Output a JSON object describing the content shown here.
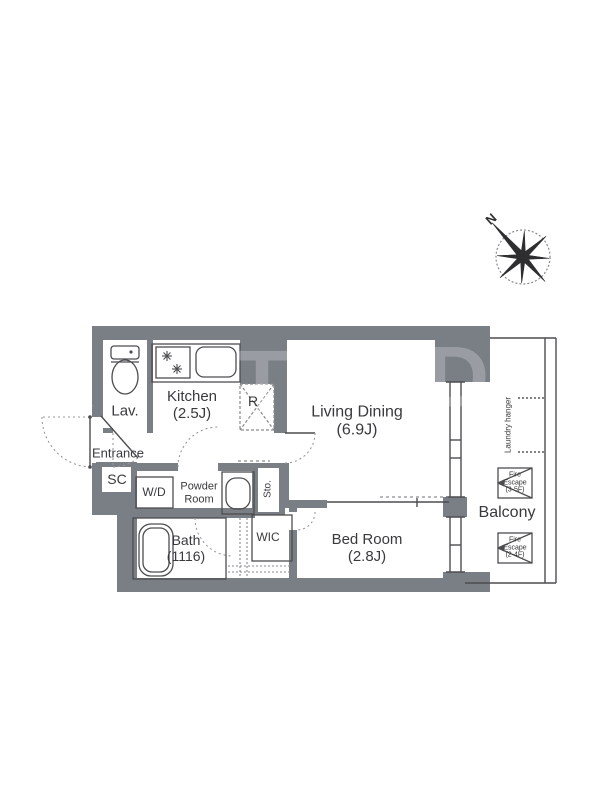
{
  "compass": {
    "north_label": "N"
  },
  "rooms": {
    "lav": {
      "label": "Lav."
    },
    "kitchen": {
      "label": "Kitchen",
      "size": "(2.5J)"
    },
    "refrigerator": {
      "label": "R"
    },
    "living": {
      "label": "Living Dining",
      "size": "(6.9J)"
    },
    "entrance": {
      "label": "Entrance"
    },
    "shoe_closet": {
      "label": "SC"
    },
    "washer_dryer": {
      "label": "W/D"
    },
    "powder_room": {
      "line1": "Powder",
      "line2": "Room"
    },
    "storage": {
      "label": "Sto."
    },
    "bath": {
      "label": "Bath",
      "size": "(1116)"
    },
    "wic": {
      "label": "WIC"
    },
    "bedroom": {
      "label": "Bed Room",
      "size": "(2.8J)"
    },
    "balcony": {
      "label": "Balcony"
    },
    "laundry_hanger": {
      "label": "Laundry hanger"
    },
    "fire_escape_upper": {
      "line1": "Fire",
      "line2": "Escape",
      "line3": "(3-5F)"
    },
    "fire_escape_lower": {
      "line1": "Fire",
      "line2": "Escape",
      "line3": "(2-4F)"
    }
  },
  "watermark": {
    "l1": "R",
    "l2": "T",
    "l3": "D"
  },
  "colors": {
    "wall": "#7a7e85",
    "line": "#4d4d50",
    "text": "#3a3a3d"
  }
}
